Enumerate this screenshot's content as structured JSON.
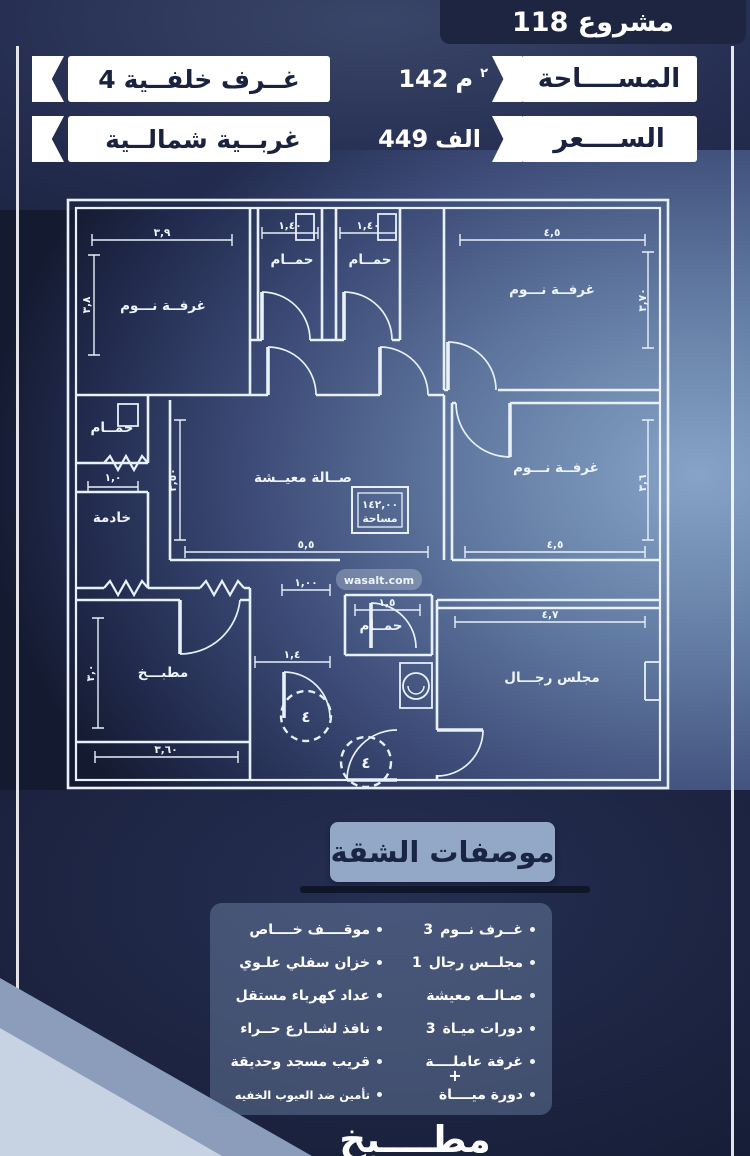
{
  "header": {
    "title": "مشروع 118",
    "stats": [
      {
        "label": "المســــاحة",
        "num": "142",
        "unit": "م",
        "sup": "٢"
      },
      {
        "label": "الســــعر",
        "num": "449",
        "unit": "الف",
        "sup": ""
      }
    ],
    "badges": [
      {
        "num": "4",
        "text": "غــرف خلفــية"
      },
      {
        "num": "",
        "text": "غربــية شمالــية"
      }
    ]
  },
  "floorplan": {
    "watermark": "wasalt.com",
    "area_box": {
      "value": "١٤٢,٠٠",
      "label": "مساحة"
    },
    "rooms": {
      "bedroom_top_left": "غرفــة نـــوم",
      "bath_top_1": "حمــام",
      "bath_top_2": "حمــام",
      "bedroom_top_right": "غرفــة نـــوم",
      "bath_left": "حمــام",
      "maid_room": "خادمة",
      "living_hall": "صــالة معيــشة",
      "bedroom_mid_right": "غرفــة نـــوم",
      "kitchen": "مطبـــخ",
      "bath_mid": "حمــام",
      "majlis": "مجلس رجـــال"
    },
    "dims": {
      "bedroom_tl_w": "٣,٩",
      "bedroom_tl_h": "٣,٨",
      "bath1_w": "١,٤٠",
      "bath2_w": "١,٤٠",
      "bedroom_tr_w": "٤,٥",
      "bedroom_tr_h": "٣,٧٠",
      "bath_left_w": "١,٠",
      "living_h": "٣,٥٠",
      "living_w": "٥,٥",
      "hall_w": "١,٠٠",
      "bedroom_mr_w": "٤,٥",
      "bedroom_mr_h": "٣,٦",
      "kitchen_h": "٣,٠",
      "kitchen_w": "٣,٦٠",
      "corridor_w": "١,٤",
      "bath_mid_w": "١,٥",
      "majlis_w": "٤,٧"
    },
    "door_numbers": {
      "entry": "٤",
      "lobby": "٤"
    }
  },
  "specs": {
    "title": "موصفات الشقة",
    "plus": "+",
    "right_column": [
      {
        "num": "3",
        "text": "غــرف نــوم"
      },
      {
        "num": "1",
        "text": "مجلــس رجال"
      },
      {
        "num": "",
        "text": "صـالــه معيشة"
      },
      {
        "num": "3",
        "text": "دورات ميـاة"
      },
      {
        "num": "",
        "text": "غرفة عاملــــة"
      },
      {
        "num": "",
        "text": "دورة ميــــاة"
      }
    ],
    "left_column": [
      {
        "num": "",
        "text": "موقــــف خــــاص"
      },
      {
        "num": "",
        "text": "خزان سفلي علـوي"
      },
      {
        "num": "",
        "text": "عداد كهرباء مستقل"
      },
      {
        "num": "",
        "text": "نافذ لشــارع حــراء"
      },
      {
        "num": "",
        "text": "قريب مسجد وحديقة"
      },
      {
        "num": "",
        "text": "تأمين ضد العيوب الخفيه"
      }
    ]
  },
  "footer": {
    "kitchen": "مطــــبخ"
  }
}
